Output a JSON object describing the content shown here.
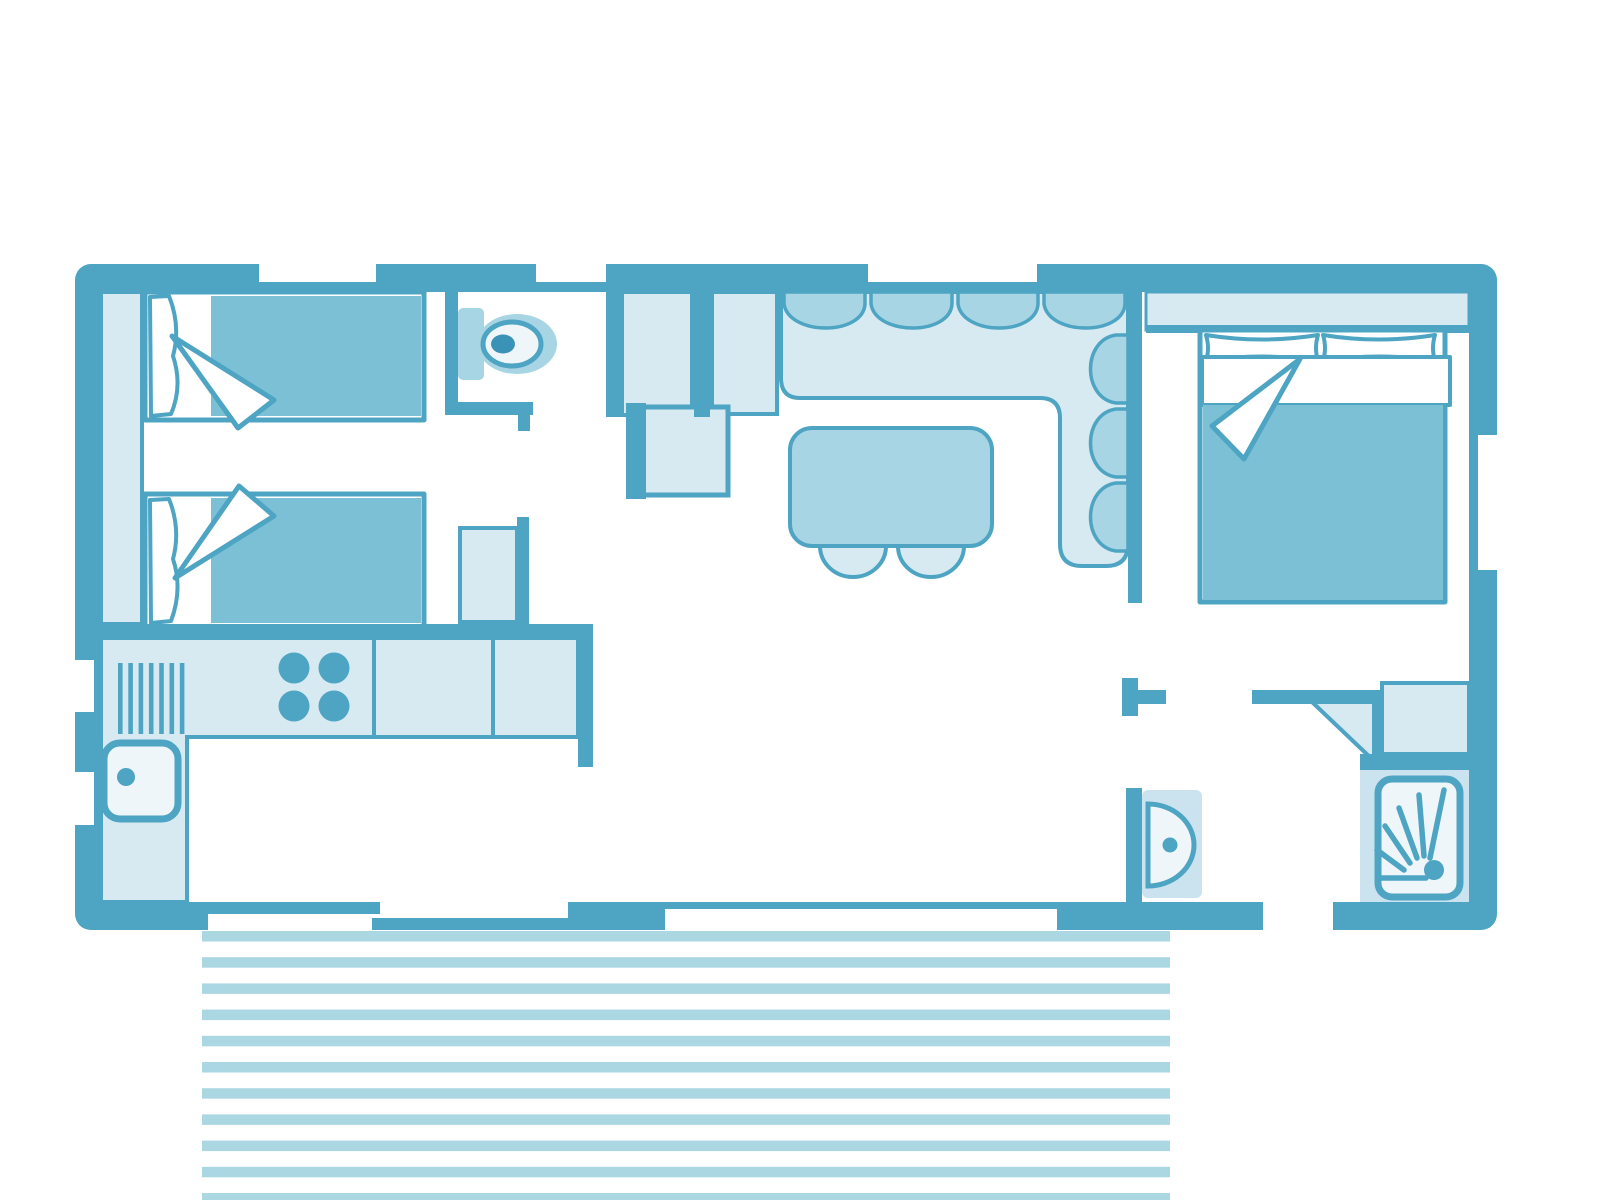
{
  "canvas": {
    "width": 1600,
    "height": 1200,
    "background": "#ffffff",
    "title": "mobile-home floor plan"
  },
  "palette": {
    "wall": "#4da4c3",
    "teal": "#7bc0d5",
    "medium": "#a8d5e3",
    "light": "#d7eaf2",
    "light2": "#cbe3ee",
    "pale": "#eef6fa",
    "stripe": "#abd7e3",
    "accent": "#3a93b6",
    "white": "#ffffff"
  },
  "rooms": [
    {
      "name": "twin-bedroom",
      "furniture": [
        "wardrobe",
        "single-bed",
        "single-bed",
        "closet"
      ]
    },
    {
      "name": "wc",
      "furniture": [
        "toilet"
      ]
    },
    {
      "name": "kitchen",
      "furniture": [
        "counter",
        "drainer",
        "hob",
        "sink"
      ]
    },
    {
      "name": "living-dining",
      "furniture": [
        "tall-cabinet",
        "tall-cabinet",
        "fridge-unit",
        "corner-sofa",
        "dining-table",
        "chair",
        "chair"
      ]
    },
    {
      "name": "master-bedroom",
      "furniture": [
        "wardrobe",
        "double-bed"
      ]
    },
    {
      "name": "bathroom",
      "furniture": [
        "washbasin",
        "cabinet",
        "shower"
      ]
    },
    {
      "name": "terrace",
      "furniture": [
        "decking"
      ]
    }
  ],
  "patterns": {
    "decking": {
      "x": 202,
      "width": 968,
      "y": 931,
      "count": 11,
      "step": 26.2,
      "thickness": 10.5
    },
    "drainer": {
      "x": 118,
      "y": 663,
      "height": 71,
      "count": 7,
      "step": 10.3,
      "thickness": 4.6
    },
    "hob": {
      "cx": [
        294,
        334
      ],
      "cy": [
        668,
        706
      ],
      "r": 15.5
    }
  }
}
